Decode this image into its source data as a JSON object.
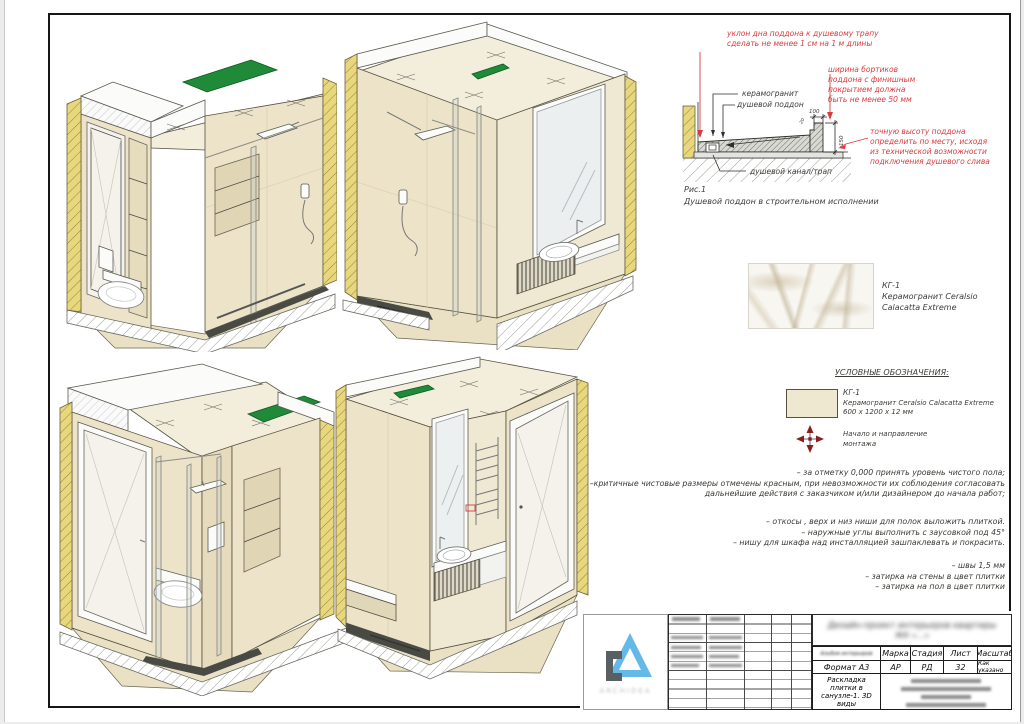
{
  "red_notes": {
    "slope": "уклон дна поддона к душевому трапу\nсделать не менее 1 см на 1 м длины",
    "curb": "ширина бортиков\nподдона с финишным\nпокрытием должна\nбыть не менее 50 мм",
    "height": "точную высоту поддона\nопределить по месту, исходя\nиз технической возможности\nподключения душевого слива"
  },
  "detail": {
    "label_ceramic": "керамогранит",
    "label_pan": "душевой поддон",
    "label_drain": "душевой канал/трап",
    "dim_top": "100",
    "dim_right": "150",
    "dim_slope": "20",
    "fig": "Рис.1",
    "caption": "Душевой поддон в строительном исполнении"
  },
  "material": {
    "code": "КГ-1",
    "line1": "Керамогранит Ceralsio",
    "line2": "Calacatta Extreme"
  },
  "legend": {
    "title": "УСЛОВНЫЕ ОБОЗНАЧЕНИЯ:",
    "tile_code": "КГ-1",
    "tile_name": "Керамогранит Ceralsio Calacatta Extreme",
    "tile_size": "600 х 1200 х 12 мм",
    "mount": "Начало и направление\nмонтажа"
  },
  "notes": {
    "p1": "– за отметку 0,000 принять уровень чистого пола;\n–критичные чистовые размеры отмечены красным, при невозможности их соблюдения согласовать\nдальнейшие действия с заказчиком и/или дизайнером до начала работ;",
    "p2": "– откосы , верх и низ ниши для полок выложить плиткой.\n– наружные углы выполнить с заусовкой под 45°\n– нишу для шкафа над инсталляцией зашпаклевать и покрасить.",
    "p3": "– швы 1,5 мм\n– затирка на стены в цвет плитки\n– затирка на пол в цвет плитки"
  },
  "titleblock": {
    "project1": "Дизайн-проект интерьеров квартиры",
    "project2": "ЖК «...»",
    "album": "Альбом интерьеров",
    "format": "Формат А3",
    "h_marka": "Марка",
    "v_marka": "АР",
    "h_stadia": "Стадия",
    "v_stadia": "РД",
    "h_list": "Лист",
    "v_list": "32",
    "h_scale": "Масштаб",
    "v_scale": "Как указано",
    "doc_title": "Раскладка плитки в\nсанузле-1. 3D виды",
    "logo": "ARCHIDEA"
  },
  "colors": {
    "accent_red": "#d93c3f",
    "accent_green": "#1f8a38",
    "wall_yellow": "#e9d77c",
    "tile_beige": "#ece3c8",
    "logo_blue": "#64b9e6"
  }
}
